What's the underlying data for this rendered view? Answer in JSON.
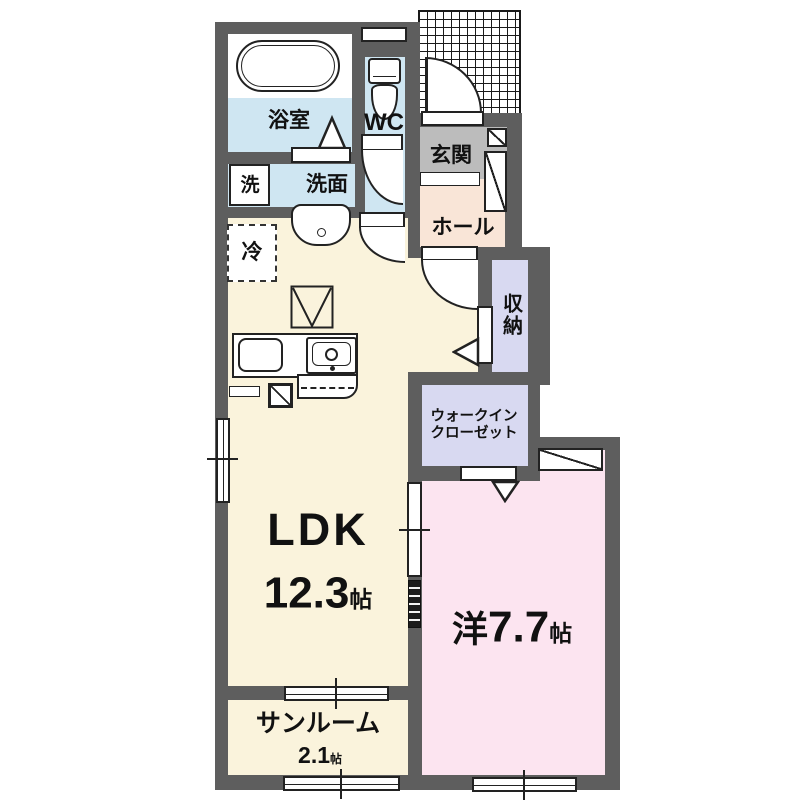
{
  "plan_title": "1LDK apartment floor plan",
  "rooms": {
    "bath": {
      "label": "浴室"
    },
    "wc": {
      "label": "WC"
    },
    "genkan": {
      "label": "玄関"
    },
    "hall": {
      "label": "ホール"
    },
    "laundry": {
      "label": "洗"
    },
    "washroom": {
      "label": "洗面"
    },
    "fridge": {
      "label": "冷"
    },
    "storage": {
      "label": "収納"
    },
    "wic": {
      "line1": "ウォークイン",
      "line2": "クローゼット"
    },
    "ldk": {
      "label": "LDK",
      "size": "12.3",
      "unit": "帖"
    },
    "western": {
      "label": "洋",
      "size": "7.7",
      "unit": "帖"
    },
    "sunroom": {
      "label": "サンルーム",
      "size": "2.1",
      "unit": "帖"
    }
  },
  "colors": {
    "wall": "#5E5E5E",
    "wet_rooms": "#CFE6F2",
    "ldk": "#FAF3DC",
    "western_room": "#FCE4F0",
    "hall": "#F9E5D7",
    "genkan": "#BCBCBC",
    "closets": "#D8D9F1",
    "line": "#222222"
  }
}
